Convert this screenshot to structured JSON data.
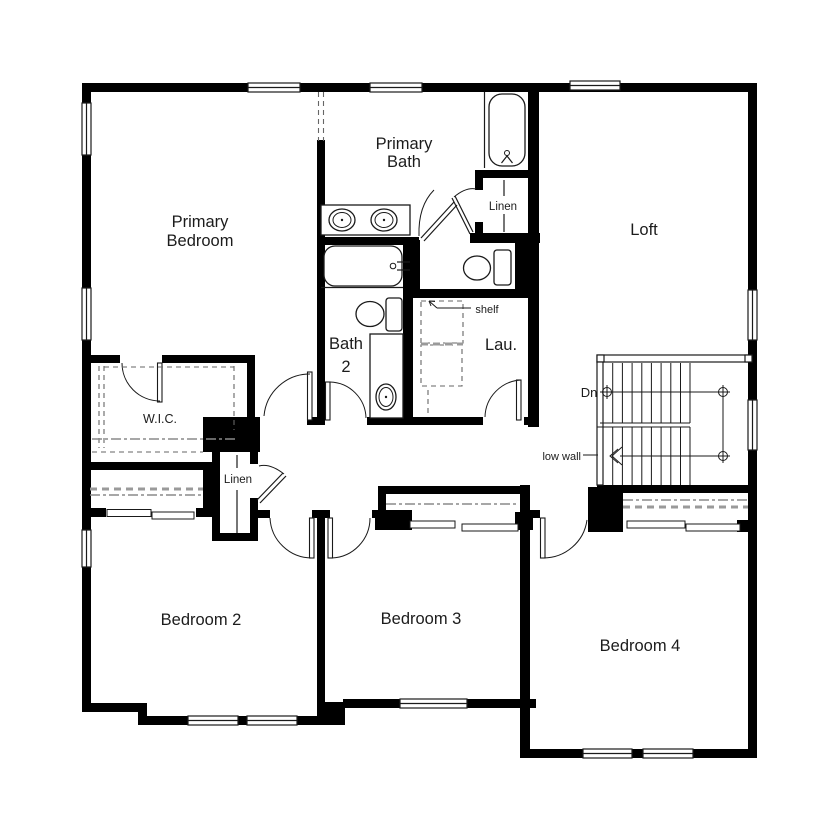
{
  "floor_plan": {
    "rooms": {
      "primary_bedroom": {
        "line1": "Primary",
        "line2": "Bedroom"
      },
      "primary_bath": {
        "line1": "Primary",
        "line2": "Bath"
      },
      "loft": {
        "label": "Loft"
      },
      "wic": {
        "label": "W.I.C."
      },
      "bath2": {
        "line1": "Bath",
        "line2": "2"
      },
      "laundry": {
        "label": "Lau."
      },
      "linen_upper": {
        "label": "Linen"
      },
      "linen_lower": {
        "label": "Linen"
      },
      "bedroom2": {
        "label": "Bedroom 2"
      },
      "bedroom3": {
        "label": "Bedroom 3"
      },
      "bedroom4": {
        "label": "Bedroom 4"
      }
    },
    "annotations": {
      "shelf": "shelf",
      "down": "Dn",
      "low_wall": "low wall"
    },
    "colors": {
      "wall": "#000000",
      "background": "#ffffff",
      "line": "#1a1a1a",
      "closet_dash": "#8a8a8a"
    }
  }
}
